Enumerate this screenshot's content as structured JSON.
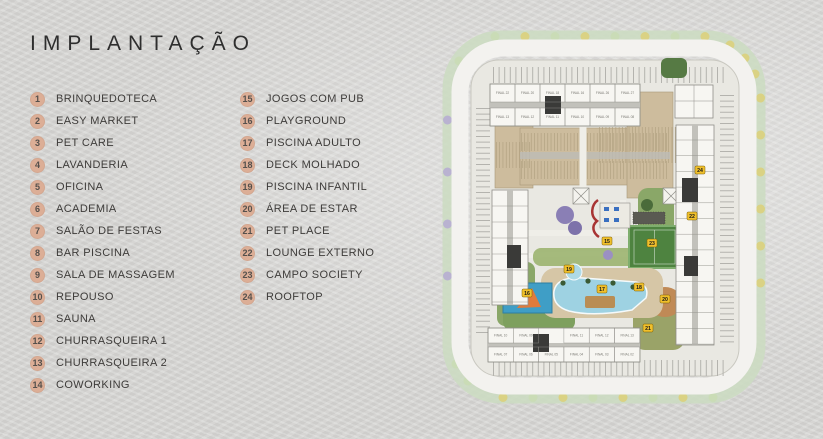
{
  "title": "IMPLANTAÇÃO",
  "legend": {
    "badge_color": "#dcae96",
    "columns": [
      {
        "items": [
          {
            "n": "1",
            "label": "BRINQUEDOTECA"
          },
          {
            "n": "2",
            "label": "EASY MARKET"
          },
          {
            "n": "3",
            "label": "PET CARE"
          },
          {
            "n": "4",
            "label": "LAVANDERIA"
          },
          {
            "n": "5",
            "label": "OFICINA"
          },
          {
            "n": "6",
            "label": "ACADEMIA"
          },
          {
            "n": "7",
            "label": "SALÃO DE FESTAS"
          },
          {
            "n": "8",
            "label": "BAR PISCINA"
          },
          {
            "n": "9",
            "label": "SALA DE MASSAGEM"
          },
          {
            "n": "10",
            "label": "REPOUSO"
          },
          {
            "n": "11",
            "label": "SAUNA"
          },
          {
            "n": "12",
            "label": "CHURRASQUEIRA 1"
          },
          {
            "n": "13",
            "label": "CHURRASQUEIRA 2"
          },
          {
            "n": "14",
            "label": "COWORKING"
          }
        ]
      },
      {
        "items": [
          {
            "n": "15",
            "label": "JOGOS COM PUB"
          },
          {
            "n": "16",
            "label": "PLAYGROUND"
          },
          {
            "n": "17",
            "label": "PISCINA ADULTO"
          },
          {
            "n": "18",
            "label": "DECK MOLHADO"
          },
          {
            "n": "19",
            "label": "PISCINA INFANTIL"
          },
          {
            "n": "20",
            "label": "ÁREA DE ESTAR"
          },
          {
            "n": "21",
            "label": "PET PLACE"
          },
          {
            "n": "22",
            "label": "LOUNGE EXTERNO"
          },
          {
            "n": "23",
            "label": "CAMPO SOCIETY"
          },
          {
            "n": "24",
            "label": "ROOFTOP"
          }
        ]
      }
    ]
  },
  "plan": {
    "colors": {
      "green_ring": "#ccdbc2",
      "road": "#f3f2ef",
      "site": "#e9e8e2",
      "building": "#f7f6f2",
      "building_line": "#8f8e88",
      "core_dark": "#3a3a38",
      "tan_parking": "#cdbc9d",
      "tan_hatch": "#b2a282",
      "field_green": "#4e8340",
      "pool_blue": "#9ed2e2",
      "court_blue": "#3f9ec6",
      "court_orange": "#e07b3c",
      "garden_green": "#8aa768",
      "garden_olive": "#9aa368",
      "earth_brown": "#c08a56",
      "marker_yellow": "#f0c02c",
      "red_wall": "#a83434",
      "tick_gray": "#b4b3ae",
      "tree_green": "#c9dcb4",
      "tree_yellow": "#dcd078",
      "tree_purple": "#b5aad2"
    },
    "markers": [
      {
        "n": "15",
        "x": 174,
        "y": 241
      },
      {
        "n": "16",
        "x": 94,
        "y": 293
      },
      {
        "n": "17",
        "x": 169,
        "y": 289
      },
      {
        "n": "18",
        "x": 206,
        "y": 287
      },
      {
        "n": "19",
        "x": 136,
        "y": 269
      },
      {
        "n": "20",
        "x": 232,
        "y": 299
      },
      {
        "n": "21",
        "x": 215,
        "y": 328
      },
      {
        "n": "22",
        "x": 259,
        "y": 216
      },
      {
        "n": "23",
        "x": 219,
        "y": 243
      },
      {
        "n": "24",
        "x": 267,
        "y": 170
      }
    ],
    "units": {
      "top_row1": [
        "FINAL 22",
        "FINAL 20",
        "FINAL 18",
        "FINAL 16",
        "FINAL 26",
        "FINAL 27"
      ],
      "top_row2": [
        "FINAL 13",
        "FINAL 12",
        "FINAL 11",
        "FINAL 10",
        "FINAL 09",
        "FINAL 08"
      ],
      "bottom_row1": [
        "FINAL 10",
        "FINAL 09",
        "FINAL 11",
        "FINAL 12",
        "FINAL 13"
      ],
      "bottom_row2": [
        "FINAL 07",
        "FINAL 06",
        "FINAL 05",
        "FINAL 04",
        "FINAL 03",
        "FINAL 02"
      ]
    }
  }
}
